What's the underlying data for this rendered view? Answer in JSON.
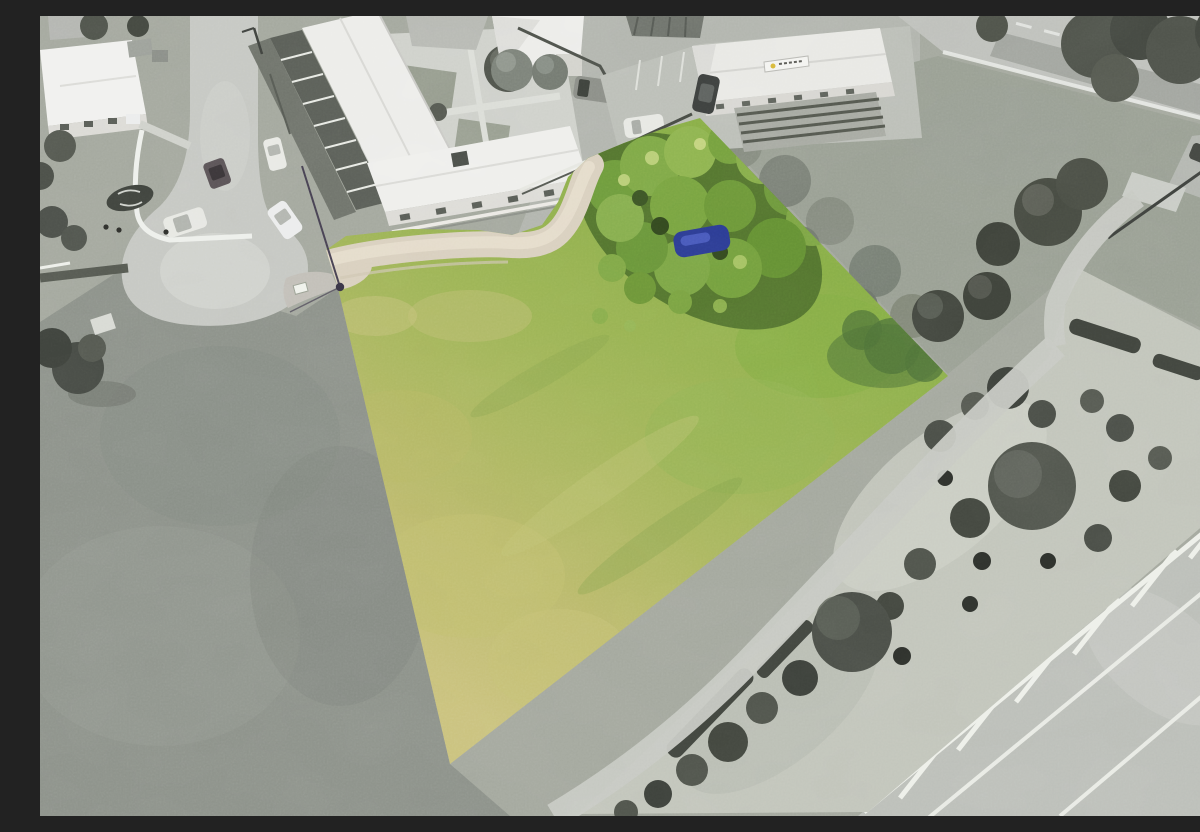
{
  "meta": {
    "type": "aerial-photograph",
    "alt": "Aerial drone photo of a vacant corner section highlighted in colour; surrounding streets, houses and gardens are desaturated to grayscale",
    "description": "Real-estate style aerial image: a grassy quadrilateral lot shown in colour (green to dry-yellow grass, overgrown shrub mound with a blue tarpaulin, beige gravel driveway, power pole with overhead wires) amid a grayscale neighbourhood with an apartment complex, motel-style building with an illegible roof sign, a cul-de-sac with parked cars, street-tree garden beds and an arterial road with white hatched median markings."
  },
  "palette": {
    "highlight_green": "#8db14c",
    "mid_grass_green": "#a3b75c",
    "dry_grass_yellow": "#c9c17c",
    "shrub_green": "#74a03e",
    "shrub_shadow_green": "#54752f",
    "tree_shadow_green": "#4f7338",
    "tarp_blue": "#2c3c94",
    "driveway_beige": "#d9d0bf",
    "grayscale_ground": "#a4a89e",
    "grayscale_field": "#8d928a",
    "road_gray": "#c6c8c3",
    "asphalt_gray": "#bcbfb9",
    "roof_white": "#efefec",
    "tree_gray": "#4b4f48",
    "marking_white": "#eef0ea",
    "sign_logo_yellow": "#d8b93a"
  },
  "scene": {
    "highlighted_lot": {
      "shape": "quadrilateral, left corner near cul-de-sac, long edges running to a point at bottom",
      "treatment": "full colour against grayscale surroundings",
      "features": [
        "mown grass, greener at top-right, drier yellow toward bottom tip",
        "overgrown shrub and scrub mound along the top boundary",
        "dark blue tarpaulin lying in the shrubs",
        "curved beige gravel driveway entering from the cul-de-sac",
        "timber power pole with overhead wires at the left corner",
        "tree shadows falling into the right corner"
      ]
    },
    "buildings": [
      "long white apartment wing with dark balcony strip (top left)",
      "single-storey white unit wing with front picket fence",
      "white weatherboard house with porch (far top left)",
      "gabled white cottage with two garden trees (top centre)",
      "white commercial building with roof sign (top right of lot)",
      "dark corrugated-iron roof house (top centre-right)"
    ],
    "sign": {
      "location": "roof edge of commercial building",
      "text_legible": false,
      "logo_color": "#d8b93a"
    },
    "roads": [
      "residential street ending in a cul-de-sac (left)",
      "two-lane road with dashed centreline and tree shadows (top right)",
      "arterial road with white edge lines and hatched median (bottom right)",
      "short side-street stub (right edge)"
    ],
    "vehicles": [
      "white car parked on cul-de-sac apron",
      "white car angled at cul-de-sac edge",
      "white sedan at kerb with pedestrians nearby",
      "dark car on cul-de-sac",
      "grey minivan in rear yard",
      "dark car beside commercial building",
      "white car in marked parking bay",
      "dark car on side-street stub",
      "dark car on arterial road (bottom right corner)"
    ],
    "landscaping": [
      "street-tree and flax garden beds with gravel mulch along the arterial road",
      "clipped dark hedges",
      "concrete footpath curving along the lot's south-east side",
      "round street trees near the lot's right corner",
      "scrubby grayscale bushes along the lot's north-east boundary"
    ]
  }
}
